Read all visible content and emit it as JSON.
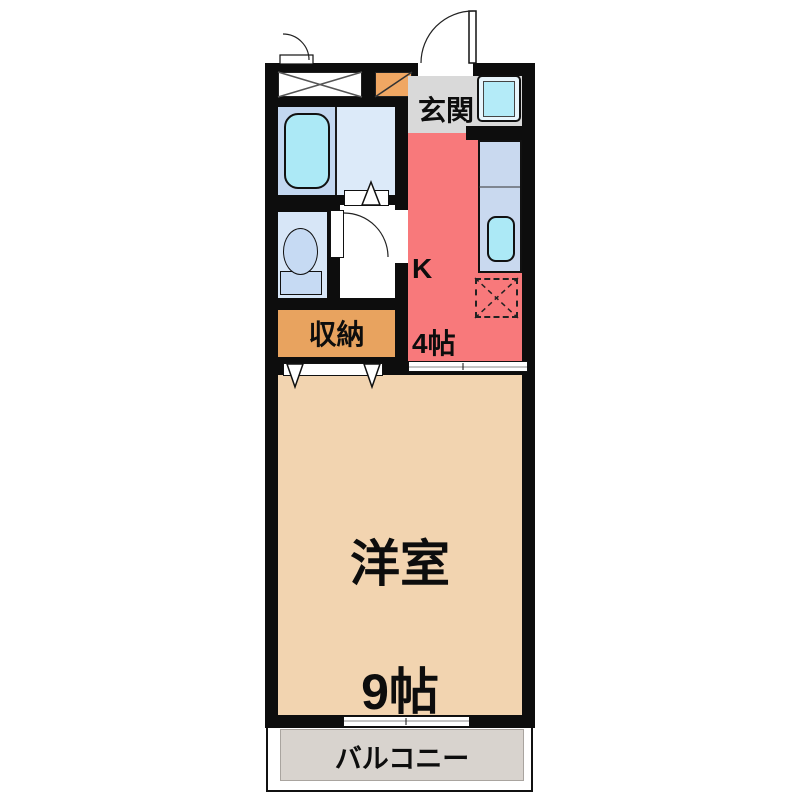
{
  "title": "apartment-floor-plan-1K",
  "labels": {
    "entrance": "玄関",
    "kitchen_abbr": "K",
    "kitchen_size": "4帖",
    "storage": "収納",
    "main_room_name": "洋室",
    "main_room_size": "9帖",
    "balcony": "バルコニー"
  },
  "colors": {
    "wall": "#0d0d0d",
    "kitchen": "#F8797B",
    "entrance_hall": "#D9D9D9",
    "western_room": "#F2D4B0",
    "storage": "#E8A35F",
    "shoe_cabinet": "#F0A763",
    "balcony": "#D8D3CE",
    "bath_floor": "#DCEAF9",
    "bath_tub_zone": "#C3D7F0",
    "bathtub": "#ACE9F6",
    "toilet_room": "#D7E6F7",
    "toilet_fixture": "#C6DAF3",
    "kitchen_counter": "#C9D9EF",
    "kitchen_sink": "#ACE9F6",
    "washer_pan": "#B4EBF8"
  },
  "fixtures": [
    "entrance-door",
    "meter-box",
    "shoe-cabinet",
    "bathtub",
    "bathroom",
    "toilet",
    "toilet-door",
    "washing-machine-space",
    "kitchen-counter",
    "kitchen-sink",
    "refrigerator-space",
    "closet-folding-door",
    "room-sliding-door",
    "balcony-window"
  ]
}
